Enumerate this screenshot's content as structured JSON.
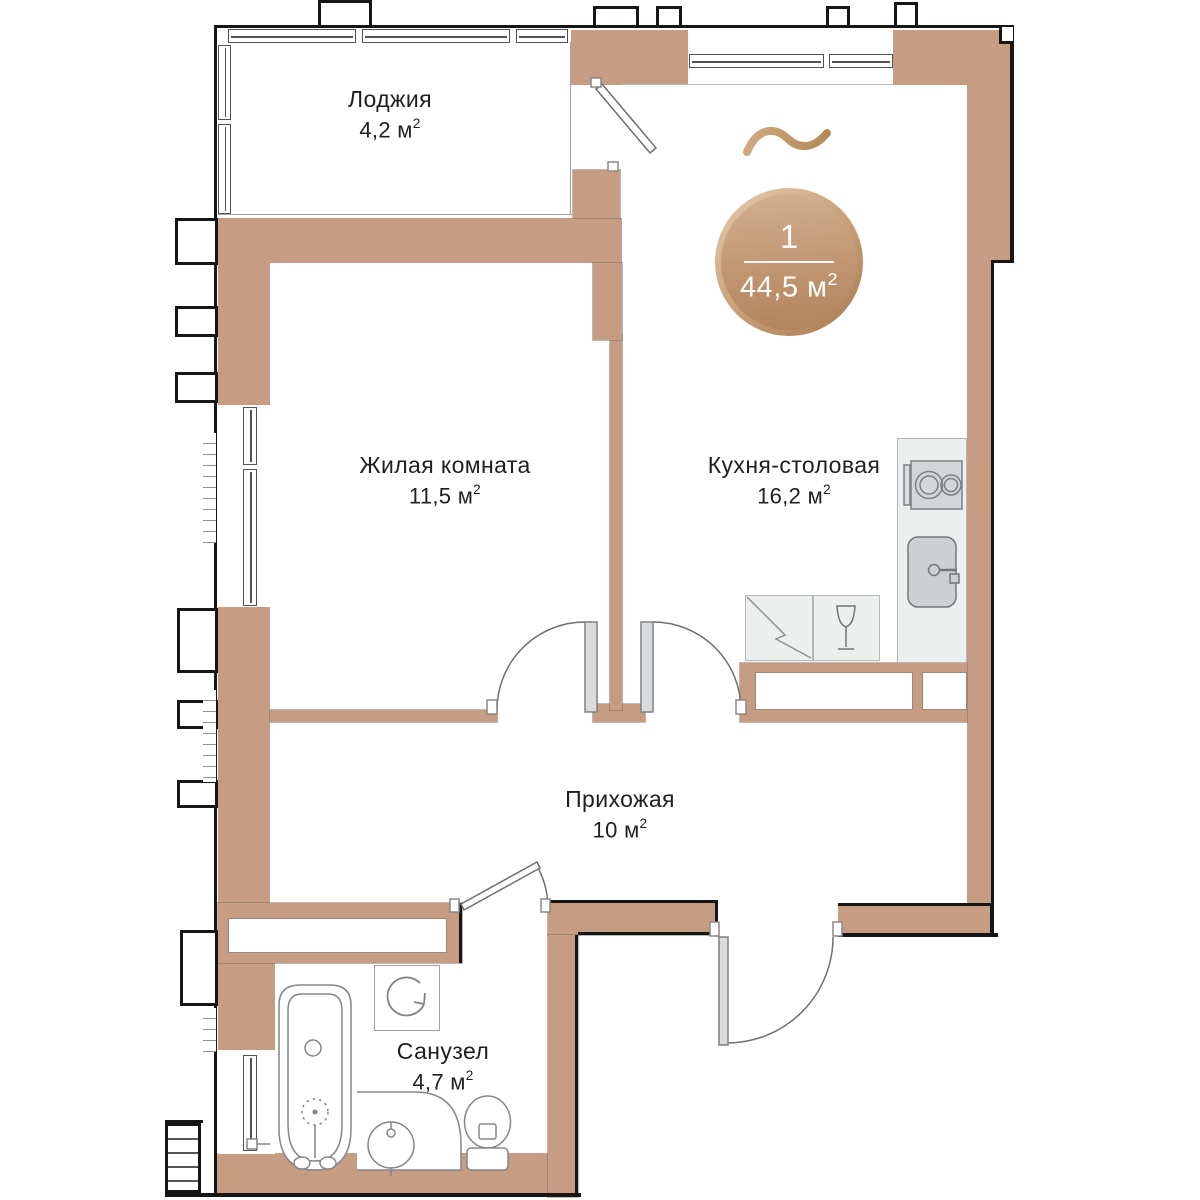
{
  "badge": {
    "number": "1",
    "area_value": "44,5",
    "area_unit": "м",
    "area_sup": "2"
  },
  "rooms": [
    {
      "name": "Лоджия",
      "area_value": "4,2",
      "area_unit": "м",
      "area_sup": "2"
    },
    {
      "name": "Жилая комната",
      "area_value": "11,5",
      "area_unit": "м",
      "area_sup": "2"
    },
    {
      "name": "Кухня-столовая",
      "area_value": "16,2",
      "area_unit": "м",
      "area_sup": "2"
    },
    {
      "name": "Прихожая",
      "area_value": "10",
      "area_unit": "м",
      "area_sup": "2"
    },
    {
      "name": "Санузел",
      "area_value": "4,7",
      "area_unit": "м",
      "area_sup": "2"
    }
  ],
  "colors": {
    "wall": "#c69c83",
    "outline": "#161616",
    "fixture_stroke": "#82878a",
    "badge_light": "#dfc3a7",
    "badge_dark": "#b2835a",
    "accent_squiggle": "#c49a6f"
  }
}
